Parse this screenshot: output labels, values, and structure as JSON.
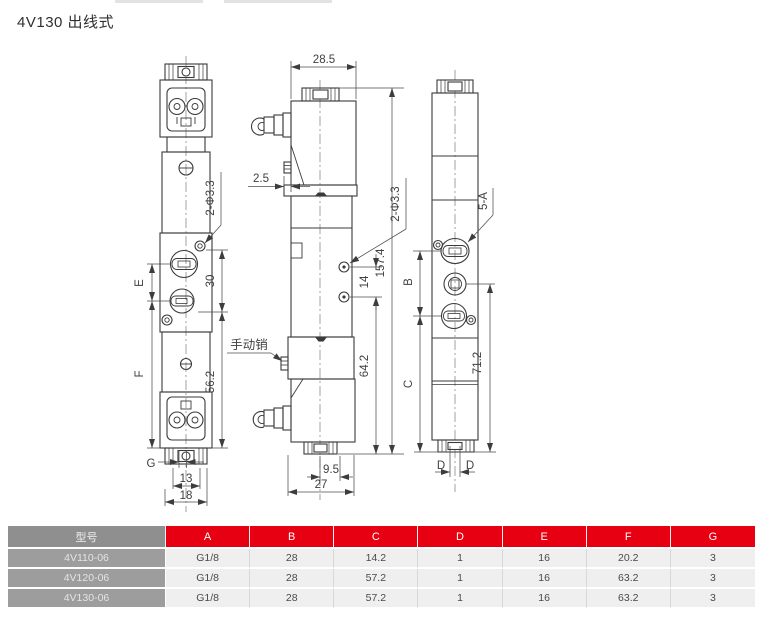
{
  "title": "4V130 出线式",
  "front_view": {
    "hole_label": "2-Φ3.3",
    "dim_30": "30",
    "dim_e": "E",
    "dim_f": "F",
    "dim_56_2": "56.2",
    "dim_g": "G",
    "dim_13": "13",
    "dim_18": "18"
  },
  "side_view": {
    "dim_28_5": "28.5",
    "dim_2_5": "2.5",
    "hole_label": "2-Φ3.3",
    "dim_14": "14",
    "dim_157_4": "157.4",
    "dim_64_2": "64.2",
    "manual_pin_label": "手动销",
    "dim_9_5": "9.5",
    "dim_27": "27"
  },
  "rear_view": {
    "port_label": "5-A",
    "dim_b": "B",
    "dim_c": "C",
    "dim_71_2": "71.2",
    "dim_d_left": "D",
    "dim_d_right": "D"
  },
  "table": {
    "headers": [
      "型号",
      "A",
      "B",
      "C",
      "D",
      "E",
      "F",
      "G"
    ],
    "rows": [
      [
        "4V110-06",
        "G1/8",
        "28",
        "14.2",
        "1",
        "16",
        "20.2",
        "3"
      ],
      [
        "4V120-06",
        "G1/8",
        "28",
        "57.2",
        "1",
        "16",
        "63.2",
        "3"
      ],
      [
        "4V130-06",
        "G1/8",
        "28",
        "57.2",
        "1",
        "16",
        "63.2",
        "3"
      ]
    ]
  },
  "colors": {
    "accent_red": "#e60012",
    "header_gray": "#8f8f8f",
    "model_gray": "#9d9d9d",
    "row_bg": "#efefef",
    "line_color": "#3b3b3b"
  }
}
